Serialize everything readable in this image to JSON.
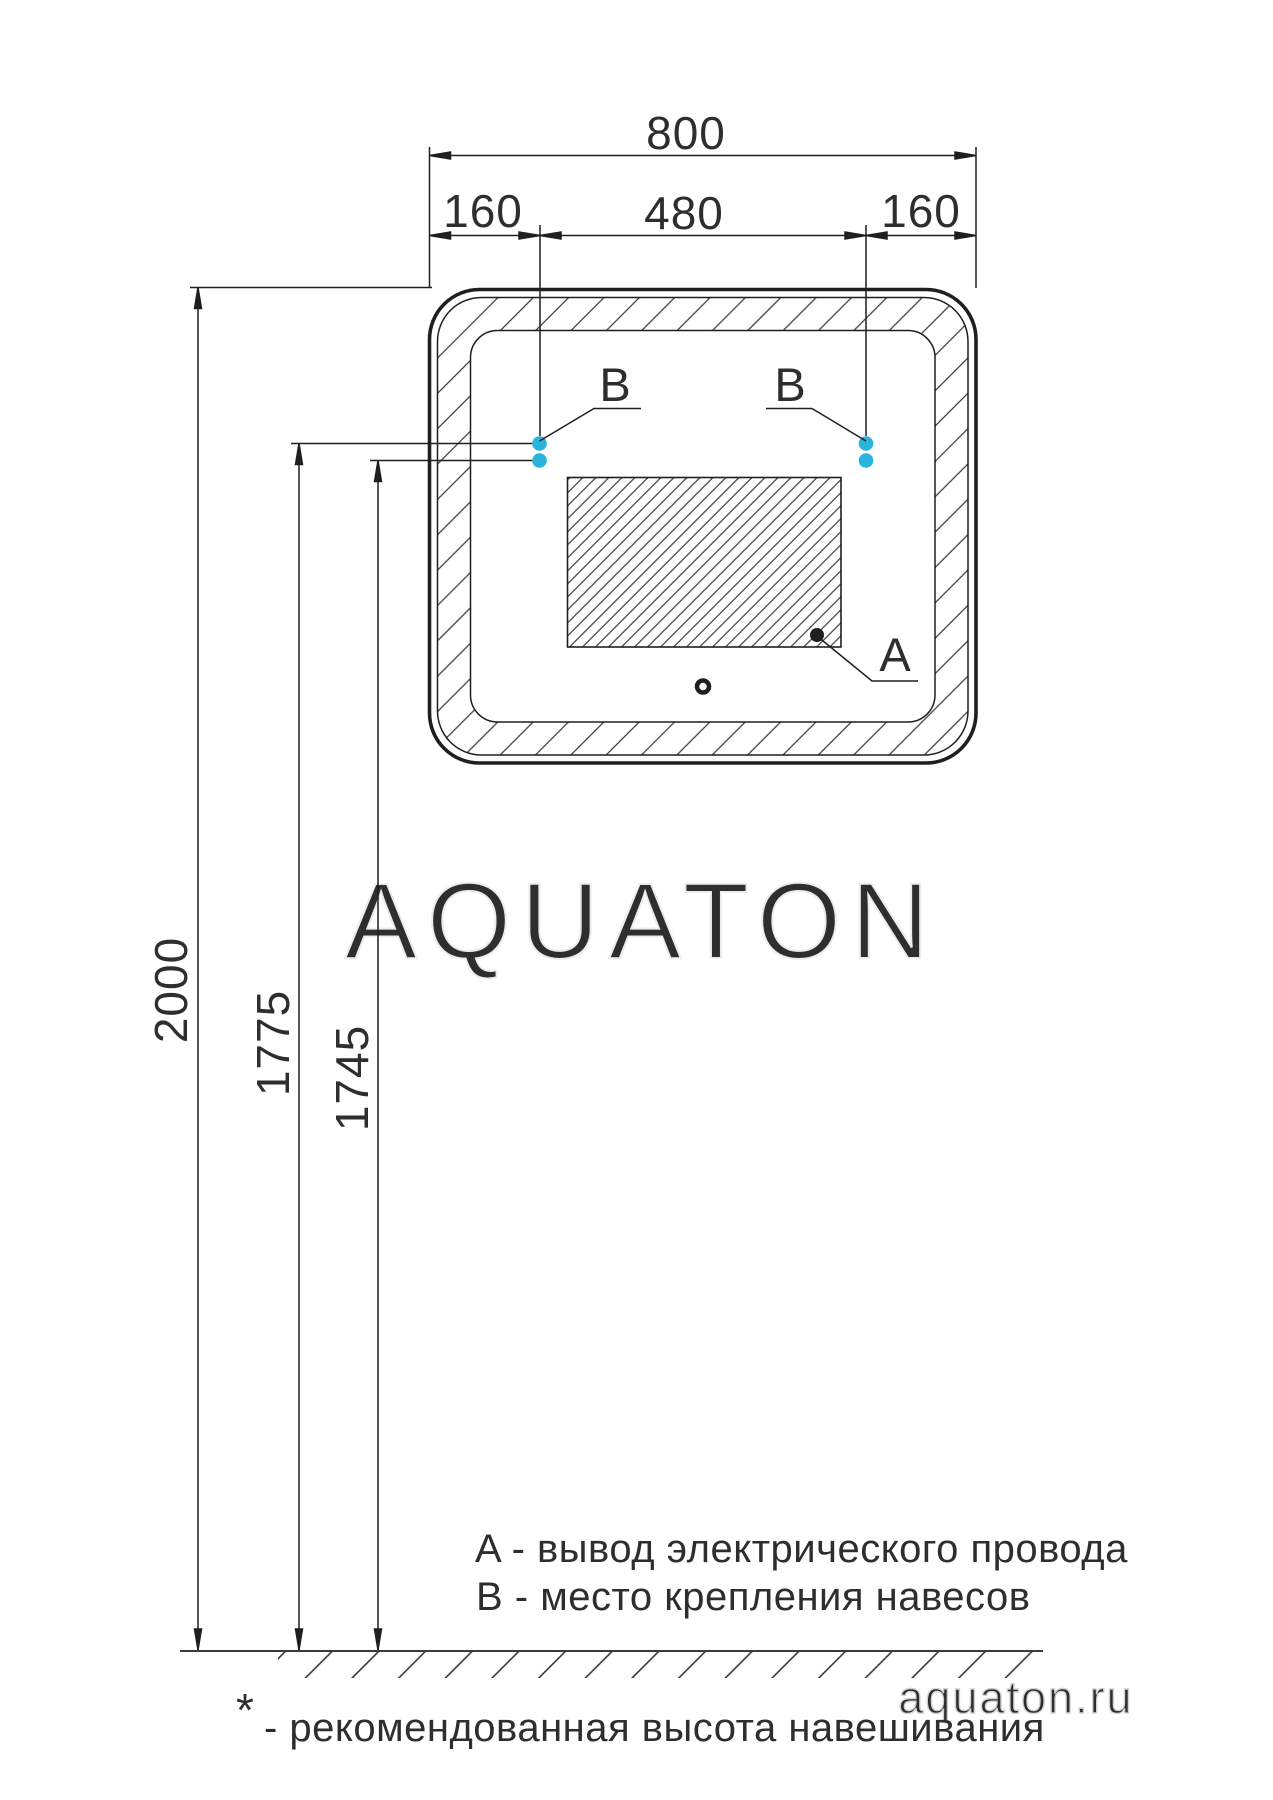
{
  "drawing": {
    "type": "mirror-installation-diagram",
    "top_dims": {
      "total": "800",
      "left": "160",
      "center": "480",
      "right": "160"
    },
    "left_dims": {
      "floor": "2000",
      "upper_mount": "1775",
      "lower_mount": "1745"
    },
    "callouts": {
      "a": "A",
      "b_left": "B",
      "b_right": "B"
    },
    "legend": {
      "a": "A - вывод электрического провода",
      "b": "B - место крепления навесов"
    },
    "footnote": {
      "mark": "*",
      "text": "- рекомендованная высота навешивания"
    },
    "watermark": {
      "center": "AQUATON",
      "site": "aquaton.ru"
    },
    "colors": {
      "ink": "#1f1f1f",
      "mount_dot": "#28b4dc",
      "watermark_center": "#ececec",
      "watermark_site": "#d2d2d2"
    }
  }
}
